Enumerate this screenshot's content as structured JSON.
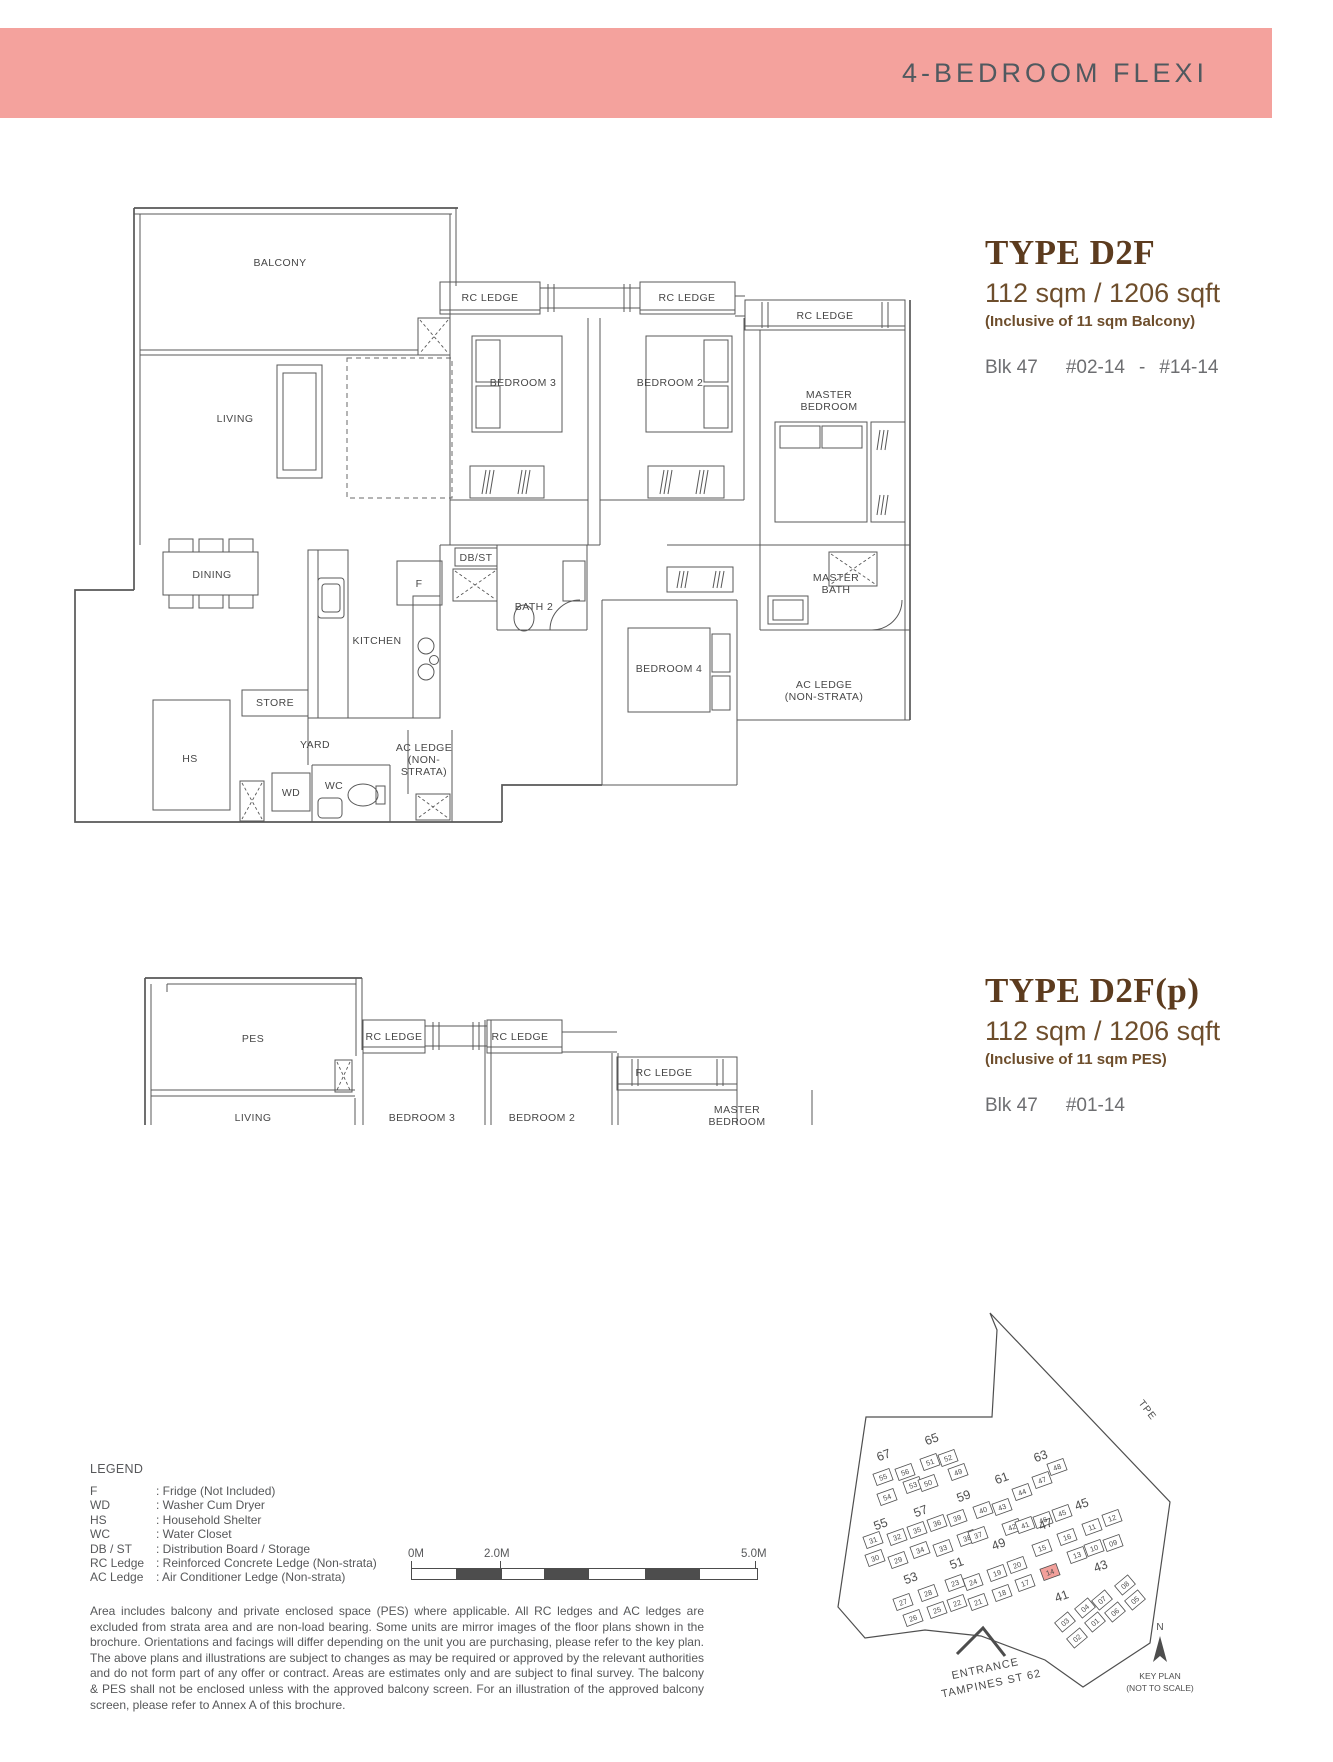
{
  "header": {
    "title": "4-BEDROOM FLEXI"
  },
  "colors": {
    "band": "#f4a29d",
    "band_text": "#50595f",
    "title_brown": "#5c3b1e",
    "area_brown": "#6e4e2c",
    "gray_text": "#6d6e71",
    "line": "#585858",
    "highlight": "#f2a09b"
  },
  "plan1": {
    "type_label": "TYPE D2F",
    "area": "112 sqm / 1206 sqft",
    "note": "(Inclusive of 11 sqm Balcony)",
    "block": "Blk 47",
    "unit_from": "#02-14",
    "range_dash": "-",
    "unit_to": "#14-14",
    "rooms": [
      {
        "l": [
          "BALCONY"
        ],
        "x": 208,
        "y": 66
      },
      {
        "l": [
          "LIVING"
        ],
        "x": 163,
        "y": 222
      },
      {
        "l": [
          "RC LEDGE"
        ],
        "x": 418,
        "y": 101
      },
      {
        "l": [
          "RC LEDGE"
        ],
        "x": 615,
        "y": 101
      },
      {
        "l": [
          "RC LEDGE"
        ],
        "x": 753,
        "y": 119
      },
      {
        "l": [
          "BEDROOM 3"
        ],
        "x": 451,
        "y": 186
      },
      {
        "l": [
          "BEDROOM 2"
        ],
        "x": 598,
        "y": 186
      },
      {
        "l": [
          "MASTER",
          "BEDROOM"
        ],
        "x": 757,
        "y": 198
      },
      {
        "l": [
          "DINING"
        ],
        "x": 140,
        "y": 378
      },
      {
        "l": [
          "KITCHEN"
        ],
        "x": 305,
        "y": 444
      },
      {
        "l": [
          "F"
        ],
        "x": 347,
        "y": 387
      },
      {
        "l": [
          "DB/ST"
        ],
        "x": 404,
        "y": 361
      },
      {
        "l": [
          "BATH 2"
        ],
        "x": 462,
        "y": 410
      },
      {
        "l": [
          "BEDROOM 4"
        ],
        "x": 597,
        "y": 472
      },
      {
        "l": [
          "MASTER",
          "BATH"
        ],
        "x": 764,
        "y": 381
      },
      {
        "l": [
          "AC LEDGE",
          "(NON-STRATA)"
        ],
        "x": 752,
        "y": 488
      },
      {
        "l": [
          "STORE"
        ],
        "x": 203,
        "y": 506
      },
      {
        "l": [
          "YARD"
        ],
        "x": 243,
        "y": 548
      },
      {
        "l": [
          "HS"
        ],
        "x": 118,
        "y": 562
      },
      {
        "l": [
          "WD"
        ],
        "x": 219,
        "y": 596
      },
      {
        "l": [
          "WC"
        ],
        "x": 262,
        "y": 589
      },
      {
        "l": [
          "AC LEDGE",
          "(NON-",
          "STRATA)"
        ],
        "x": 352,
        "y": 551
      }
    ]
  },
  "plan2": {
    "type_label": "TYPE D2F(p)",
    "area": "112 sqm / 1206 sqft",
    "note": "(Inclusive of 11 sqm PES)",
    "block": "Blk 47",
    "unit_from": "#01-14",
    "rooms": [
      {
        "l": [
          "PES"
        ],
        "x": 181,
        "y": 182
      },
      {
        "l": [
          "RC LEDGE"
        ],
        "x": 322,
        "y": 180
      },
      {
        "l": [
          "RC LEDGE"
        ],
        "x": 448,
        "y": 180
      },
      {
        "l": [
          "RC LEDGE"
        ],
        "x": 592,
        "y": 216
      },
      {
        "l": [
          "LIVING"
        ],
        "x": 181,
        "y": 261
      },
      {
        "l": [
          "BEDROOM 3"
        ],
        "x": 350,
        "y": 261
      },
      {
        "l": [
          "BEDROOM 2"
        ],
        "x": 470,
        "y": 261
      },
      {
        "l": [
          "MASTER",
          "BEDROOM"
        ],
        "x": 665,
        "y": 253
      }
    ]
  },
  "legend": {
    "title": "LEGEND",
    "items": [
      {
        "abbr": "F",
        "desc": ": Fridge (Not Included)"
      },
      {
        "abbr": "WD",
        "desc": ": Washer Cum Dryer"
      },
      {
        "abbr": "HS",
        "desc": ": Household Shelter"
      },
      {
        "abbr": "WC",
        "desc": ": Water Closet"
      },
      {
        "abbr": "DB / ST",
        "desc": ": Distribution Board / Storage"
      },
      {
        "abbr": "RC Ledge",
        "desc": ": Reinforced Concrete Ledge (Non-strata)"
      },
      {
        "abbr": "AC Ledge",
        "desc": ": Air Conditioner Ledge (Non-strata)"
      }
    ]
  },
  "scalebar": {
    "labels": [
      "0M",
      "2.0M",
      "5.0M"
    ]
  },
  "disclaimer": "Area includes balcony and private enclosed space (PES) where applicable. All RC ledges and AC ledges are excluded from strata area and are non-load bearing. Some units are mirror images of the floor plans shown in the brochure. Orientations and facings will differ depending on the unit you are purchasing, please refer to the key plan. The above plans and illustrations are subject to changes as may be required or approved by the relevant authorities and do not form part of any offer or contract. Areas are estimates only and are subject to final survey. The balcony & PES shall not be enclosed unless with the approved balcony screen. For an illustration of the approved balcony screen, please refer to Annex A of this brochure.",
  "keyplan": {
    "road": "TPE",
    "entrance_line1": "ENTRANCE",
    "entrance_line2": "TAMPINES ST 62",
    "north": "N",
    "caption_line1": "KEY PLAN",
    "caption_line2": "(NOT TO SCALE)",
    "blocks": [
      {
        "n": "67",
        "x": 140,
        "y": 299
      },
      {
        "n": "65",
        "x": 188,
        "y": 283
      },
      {
        "n": "63",
        "x": 297,
        "y": 300
      },
      {
        "n": "61",
        "x": 258,
        "y": 322
      },
      {
        "n": "59",
        "x": 220,
        "y": 340
      },
      {
        "n": "57",
        "x": 177,
        "y": 355
      },
      {
        "n": "55",
        "x": 137,
        "y": 368
      },
      {
        "n": "47",
        "x": 302,
        "y": 368
      },
      {
        "n": "45",
        "x": 338,
        "y": 348
      },
      {
        "n": "49",
        "x": 255,
        "y": 388
      },
      {
        "n": "51",
        "x": 213,
        "y": 407
      },
      {
        "n": "53",
        "x": 167,
        "y": 422
      },
      {
        "n": "43",
        "x": 357,
        "y": 410
      },
      {
        "n": "41",
        "x": 318,
        "y": 440
      }
    ],
    "units": [
      {
        "n": "55",
        "x": 138,
        "y": 317
      },
      {
        "n": "56",
        "x": 160,
        "y": 312
      },
      {
        "n": "51",
        "x": 185,
        "y": 302
      },
      {
        "n": "52",
        "x": 203,
        "y": 298
      },
      {
        "n": "54",
        "x": 142,
        "y": 337
      },
      {
        "n": "53",
        "x": 168,
        "y": 325
      },
      {
        "n": "50",
        "x": 183,
        "y": 323
      },
      {
        "n": "49",
        "x": 213,
        "y": 312
      },
      {
        "n": "31",
        "x": 128,
        "y": 380
      },
      {
        "n": "32",
        "x": 152,
        "y": 377
      },
      {
        "n": "35",
        "x": 172,
        "y": 370
      },
      {
        "n": "36",
        "x": 192,
        "y": 363
      },
      {
        "n": "39",
        "x": 212,
        "y": 358
      },
      {
        "n": "40",
        "x": 238,
        "y": 350
      },
      {
        "n": "43",
        "x": 257,
        "y": 347
      },
      {
        "n": "44",
        "x": 277,
        "y": 332
      },
      {
        "n": "47",
        "x": 297,
        "y": 320
      },
      {
        "n": "48",
        "x": 312,
        "y": 307
      },
      {
        "n": "30",
        "x": 130,
        "y": 398
      },
      {
        "n": "29",
        "x": 153,
        "y": 400
      },
      {
        "n": "34",
        "x": 175,
        "y": 390
      },
      {
        "n": "33",
        "x": 198,
        "y": 388
      },
      {
        "n": "38",
        "x": 222,
        "y": 378
      },
      {
        "n": "37",
        "x": 233,
        "y": 375
      },
      {
        "n": "42",
        "x": 267,
        "y": 367
      },
      {
        "n": "41",
        "x": 280,
        "y": 365
      },
      {
        "n": "46",
        "x": 298,
        "y": 360
      },
      {
        "n": "45",
        "x": 317,
        "y": 353
      },
      {
        "n": "15",
        "x": 297,
        "y": 388
      },
      {
        "n": "16",
        "x": 322,
        "y": 377
      },
      {
        "n": "11",
        "x": 347,
        "y": 367
      },
      {
        "n": "12",
        "x": 367,
        "y": 358
      },
      {
        "n": "13",
        "x": 332,
        "y": 395
      },
      {
        "n": "10",
        "x": 349,
        "y": 388
      },
      {
        "n": "09",
        "x": 368,
        "y": 383
      },
      {
        "n": "27",
        "x": 158,
        "y": 442
      },
      {
        "n": "28",
        "x": 183,
        "y": 433
      },
      {
        "n": "23",
        "x": 210,
        "y": 423
      },
      {
        "n": "24",
        "x": 228,
        "y": 422
      },
      {
        "n": "19",
        "x": 252,
        "y": 413
      },
      {
        "n": "20",
        "x": 272,
        "y": 405
      },
      {
        "n": "26",
        "x": 168,
        "y": 458
      },
      {
        "n": "25",
        "x": 192,
        "y": 450
      },
      {
        "n": "22",
        "x": 212,
        "y": 443
      },
      {
        "n": "21",
        "x": 233,
        "y": 442
      },
      {
        "n": "18",
        "x": 257,
        "y": 433
      },
      {
        "n": "17",
        "x": 280,
        "y": 423
      },
      {
        "n": "14",
        "x": 305,
        "y": 412,
        "h": true
      },
      {
        "n": "04",
        "x": 340,
        "y": 448,
        "r": -40
      },
      {
        "n": "07",
        "x": 357,
        "y": 440,
        "r": -40
      },
      {
        "n": "08",
        "x": 380,
        "y": 425,
        "r": -40
      },
      {
        "n": "03",
        "x": 320,
        "y": 462,
        "r": -40
      },
      {
        "n": "01",
        "x": 350,
        "y": 462,
        "r": -40
      },
      {
        "n": "06",
        "x": 370,
        "y": 452,
        "r": -40
      },
      {
        "n": "05",
        "x": 390,
        "y": 440,
        "r": -40
      },
      {
        "n": "02",
        "x": 332,
        "y": 478,
        "r": -40
      }
    ]
  }
}
